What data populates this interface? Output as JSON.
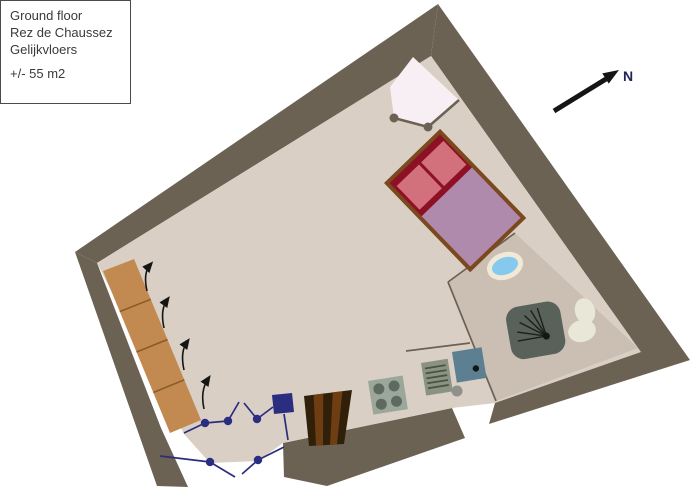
{
  "legend": {
    "line1": "Ground floor",
    "line2": "Rez de Chaussez",
    "line3": "Gelijkvloers",
    "area": "+/- 55 m2"
  },
  "compass": {
    "label": "N"
  },
  "colors": {
    "exterior": "#ffffff",
    "wall": "#6b6254",
    "floor": "#d9cfc4",
    "bathroom_floor": "#cbbeb2",
    "partition": "#6b6254",
    "door_swing_area": "#f7eff3",
    "door_hinge": "#6b6254",
    "bed_frame": "#7a4a1e",
    "bed_mattress": "#8e1024",
    "bed_pillow": "#d2707b",
    "bed_blanket": "#b08aac",
    "wardrobe": "#c28a50",
    "wardrobe_divider": "#8a5a28",
    "stairs_dark": "#30200a",
    "stairs_light": "#6e3d12",
    "cooktop_body": "#9aa79a",
    "cooktop_burner": "#5e6a5f",
    "dish_rack_body": "#8a9383",
    "dish_rack_line": "#49543f",
    "kitchen_sink": "#5c7f92",
    "faucet_knob": "#8d9189",
    "washbasin_fill": "#85c9ef",
    "washbasin_rim": "#efe9d6",
    "shower_body": "#59615b",
    "shower_line": "#1c1f1c",
    "toilet": "#e9e7d8",
    "navy": "#2a2d80",
    "arrow_black": "#151515",
    "compass_text": "#23235a",
    "legend_text": "#3a3a3a"
  }
}
